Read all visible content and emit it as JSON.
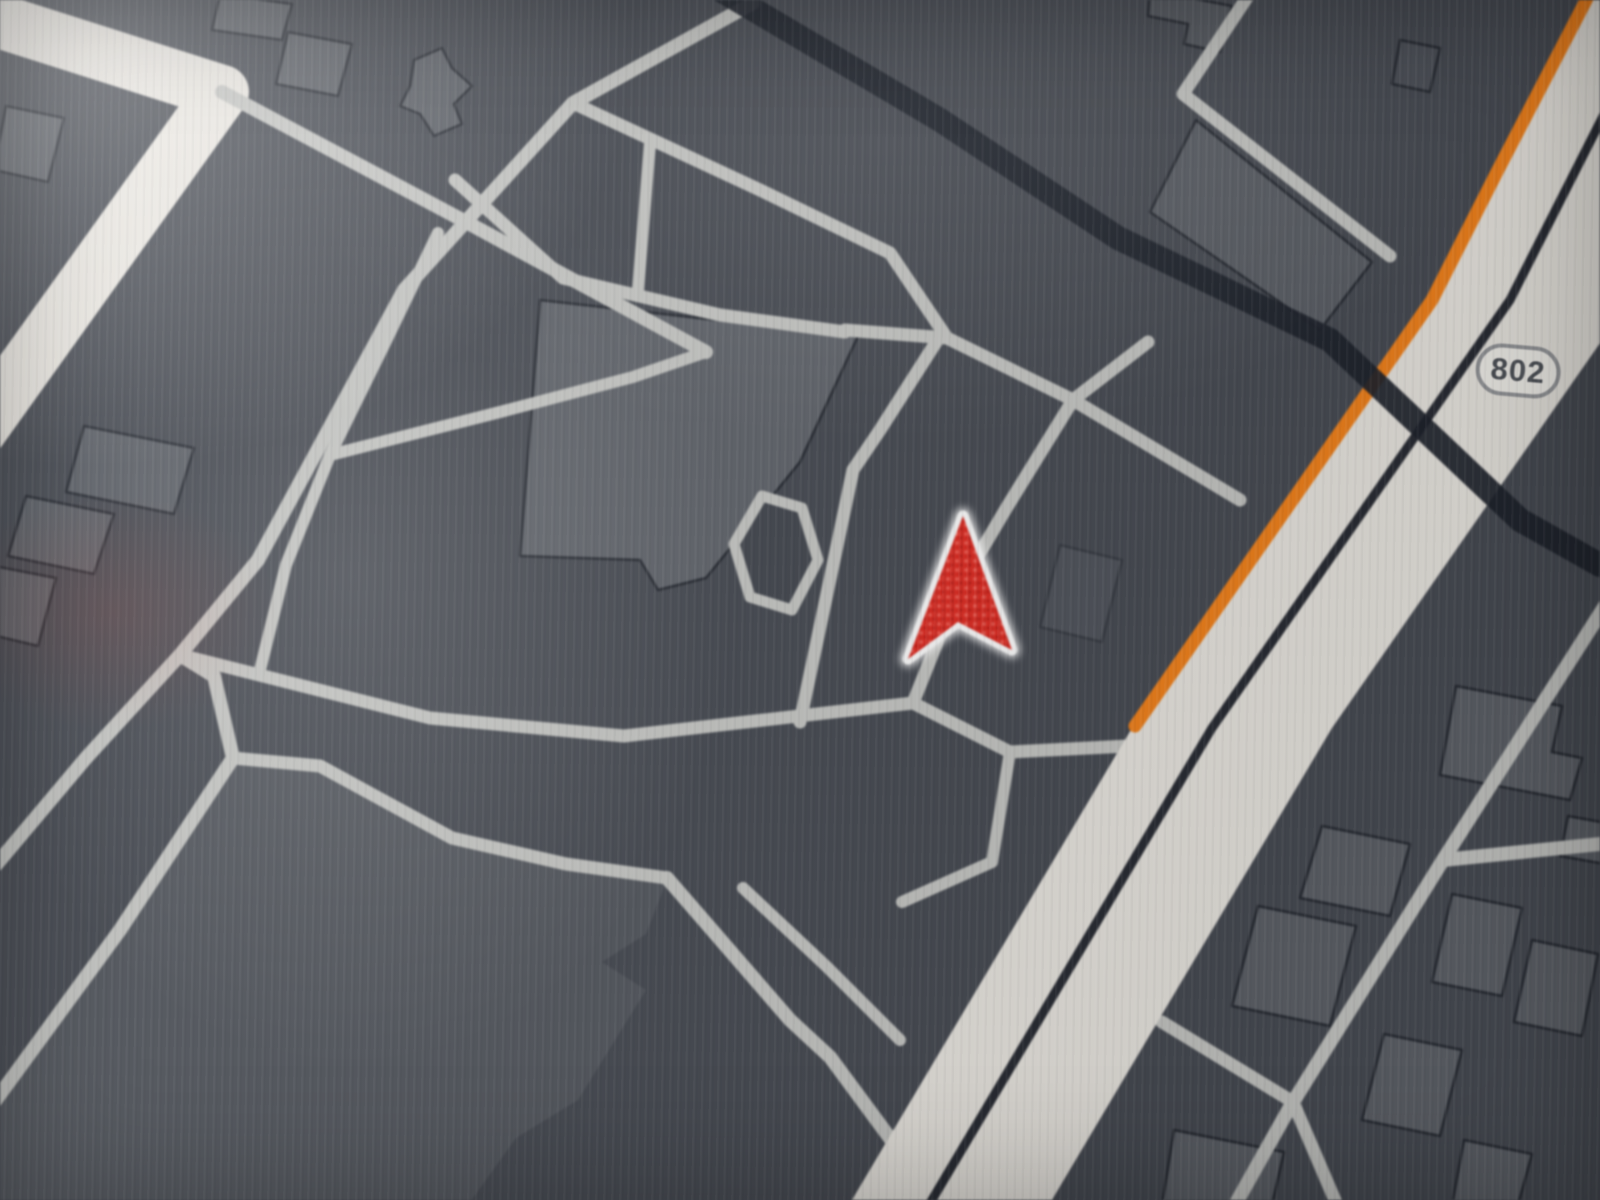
{
  "map": {
    "background_color": "#494d55",
    "street_color": "#c7c8c5",
    "major_road_color": "#ece9e3",
    "railway_color": "#20242e",
    "route_color": "#f28420",
    "median_color": "#2b2e36",
    "building_fill": "#5f636a",
    "building_outline": "#272b33",
    "land_fill": "#565a61",
    "pond_fill": "#464a52",
    "arrow": {
      "fill": "#e0362c",
      "speckle": "#ff8177",
      "outline": "#ffffff",
      "path": "M963 516 L1012 650 L958 622 L908 659 Z"
    },
    "shield": {
      "label": "802",
      "x": 1518,
      "y": 371,
      "rotation": 5
    },
    "artery": {
      "name": "main-artery",
      "points": "1592,-20 1430,300 1132,728 846,1210 1046,1210 1332,728 1630,300 1792,-20"
    },
    "artery_median": {
      "name": "artery-median",
      "points": "1672,-20 1510,300 1212,728 926,1210",
      "width": 9
    },
    "route_highlight": {
      "name": "route-highlight",
      "points": "1594,-15 1498,170 1432,300 1135,726",
      "width": 13
    },
    "railway": {
      "name": "railway-line",
      "points": "712,-15 940,120 1118,238 1330,340 1520,520 1600,565",
      "width": 24
    },
    "land_parcels": [
      {
        "name": "land-parcel-southwest",
        "points": "233,760 320,770 452,840 667,880 646,934 602,962 646,990 578,1100 516,1138 468,1205 -8,1205 -8,1112 116,932"
      }
    ],
    "pond": {
      "name": "pond-loop",
      "points": "762,496 802,508 818,560 792,610 750,597 734,544"
    },
    "streets": [
      {
        "name": "major-road-west",
        "points": "-20,15 222,92 -20,430",
        "width": 54,
        "major": true
      },
      {
        "name": "street-west-branch",
        "points": "222,92 468,223 706,352",
        "width": 14
      },
      {
        "name": "street-long-diagonal",
        "points": "753,3 573,103 404,290 258,560 180,655 86,758 -10,872",
        "width": 14
      },
      {
        "name": "street-southwest-fork",
        "points": "180,655 214,676 233,758 120,930 -10,1108",
        "width": 14
      },
      {
        "name": "street-below-arrow",
        "points": "180,655 430,718 624,736 913,703 1010,752 1128,746",
        "width": 13
      },
      {
        "name": "street-zigzag-connector",
        "points": "1010,752 992,862 902,902",
        "width": 12
      },
      {
        "name": "street-left-of-arrow",
        "points": "940,336 880,430 853,470 800,722",
        "width": 13
      },
      {
        "name": "street-right-of-arrow",
        "points": "1148,342 1073,400 1007,507 958,590 913,703",
        "width": 13
      },
      {
        "name": "street-above-arrow",
        "points": "845,330 947,338 1073,400 1240,500",
        "width": 13
      },
      {
        "name": "street-building-north",
        "points": "455,180 563,278 720,315 845,332",
        "width": 13
      },
      {
        "name": "street-north-parallel",
        "points": "573,103 760,190 890,253 947,338",
        "width": 13
      },
      {
        "name": "street-north-connector",
        "points": "650,143 638,290",
        "width": 12
      },
      {
        "name": "street-mid-connector",
        "points": "330,455 500,412 633,377 706,352",
        "width": 12
      },
      {
        "name": "street-central-vertical",
        "points": "438,233 384,345 330,455 286,565 260,670",
        "width": 12
      },
      {
        "name": "street-mass-north",
        "points": "233,758 320,766 452,838 566,864 667,878",
        "width": 13
      },
      {
        "name": "street-south-diagonal-1",
        "points": "667,878 790,1020 830,1057 912,1168 940,1210",
        "width": 14
      },
      {
        "name": "street-south-diagonal-2",
        "points": "743,888 826,966 900,1040",
        "width": 12
      },
      {
        "name": "street-east-frontage",
        "points": "1610,598 1443,860 1290,1107 1235,1205",
        "width": 14
      },
      {
        "name": "street-east-corner",
        "points": "1443,860 1502,854 1610,843",
        "width": 14
      },
      {
        "name": "street-east-connector",
        "points": "1162,1022 1293,1102 1337,1205",
        "width": 13
      },
      {
        "name": "street-topright-l",
        "points": "1252,-10 1183,94 1390,256",
        "width": 13
      }
    ],
    "buildings": [
      {
        "name": "building-central-large",
        "points": "540,300 858,336 800,462 706,578 658,590 640,560 520,556",
        "fill": "#62666d"
      },
      {
        "name": "building-plus-shaped",
        "points": "414,60 442,48 452,68 472,86 454,104 462,124 434,136 420,114 400,106 410,86"
      },
      {
        "name": "building-top-1",
        "points": "220,-6 292,4 282,40 212,30"
      },
      {
        "name": "building-top-2",
        "points": "288,32 352,44 338,96 276,84"
      },
      {
        "name": "building-top-3",
        "points": "6,106 64,118 48,182 -6,170"
      },
      {
        "name": "building-west-1",
        "points": "84,426 194,448 174,514 66,492"
      },
      {
        "name": "building-west-2",
        "points": "26,496 114,514 94,574 8,556"
      },
      {
        "name": "building-west-3",
        "points": "-6,566 56,578 38,646 -12,634"
      },
      {
        "name": "building-topright-small",
        "points": "1400,40 1440,48 1430,92 1392,84",
        "fill": "#4f535b"
      },
      {
        "name": "building-topright-zigzag",
        "points": "1150,-10 1232,6 1220,52 1184,44 1188,24 1148,16",
        "fill": "#575b62"
      },
      {
        "name": "building-topright-strip",
        "points": "1196,120 1372,262 1320,330 1150,212",
        "fill": "#5c6067"
      },
      {
        "name": "building-east-1",
        "points": "1322,826 1410,844 1390,916 1300,898"
      },
      {
        "name": "building-east-2",
        "points": "1258,906 1356,926 1330,1026 1232,1006"
      },
      {
        "name": "building-east-3",
        "points": "1452,894 1522,908 1502,996 1432,982"
      },
      {
        "name": "building-east-4",
        "points": "1532,940 1598,954 1582,1036 1514,1022"
      },
      {
        "name": "building-east-5",
        "points": "1384,1034 1462,1050 1440,1136 1362,1120"
      },
      {
        "name": "building-east-6",
        "points": "1464,1140 1532,1154 1518,1205 1452,1205"
      },
      {
        "name": "building-east-7",
        "points": "1174,1130 1284,1152 1272,1205 1162,1205"
      },
      {
        "name": "building-east-8",
        "points": "1568,816 1612,824 1605,864 1560,856"
      },
      {
        "name": "building-east-9",
        "points": "1456,686 1562,706 1552,752 1582,758 1570,800 1440,775"
      },
      {
        "name": "building-central-faint",
        "points": "1060,545 1122,560 1102,642 1040,627",
        "opacity": 0.45
      }
    ]
  }
}
